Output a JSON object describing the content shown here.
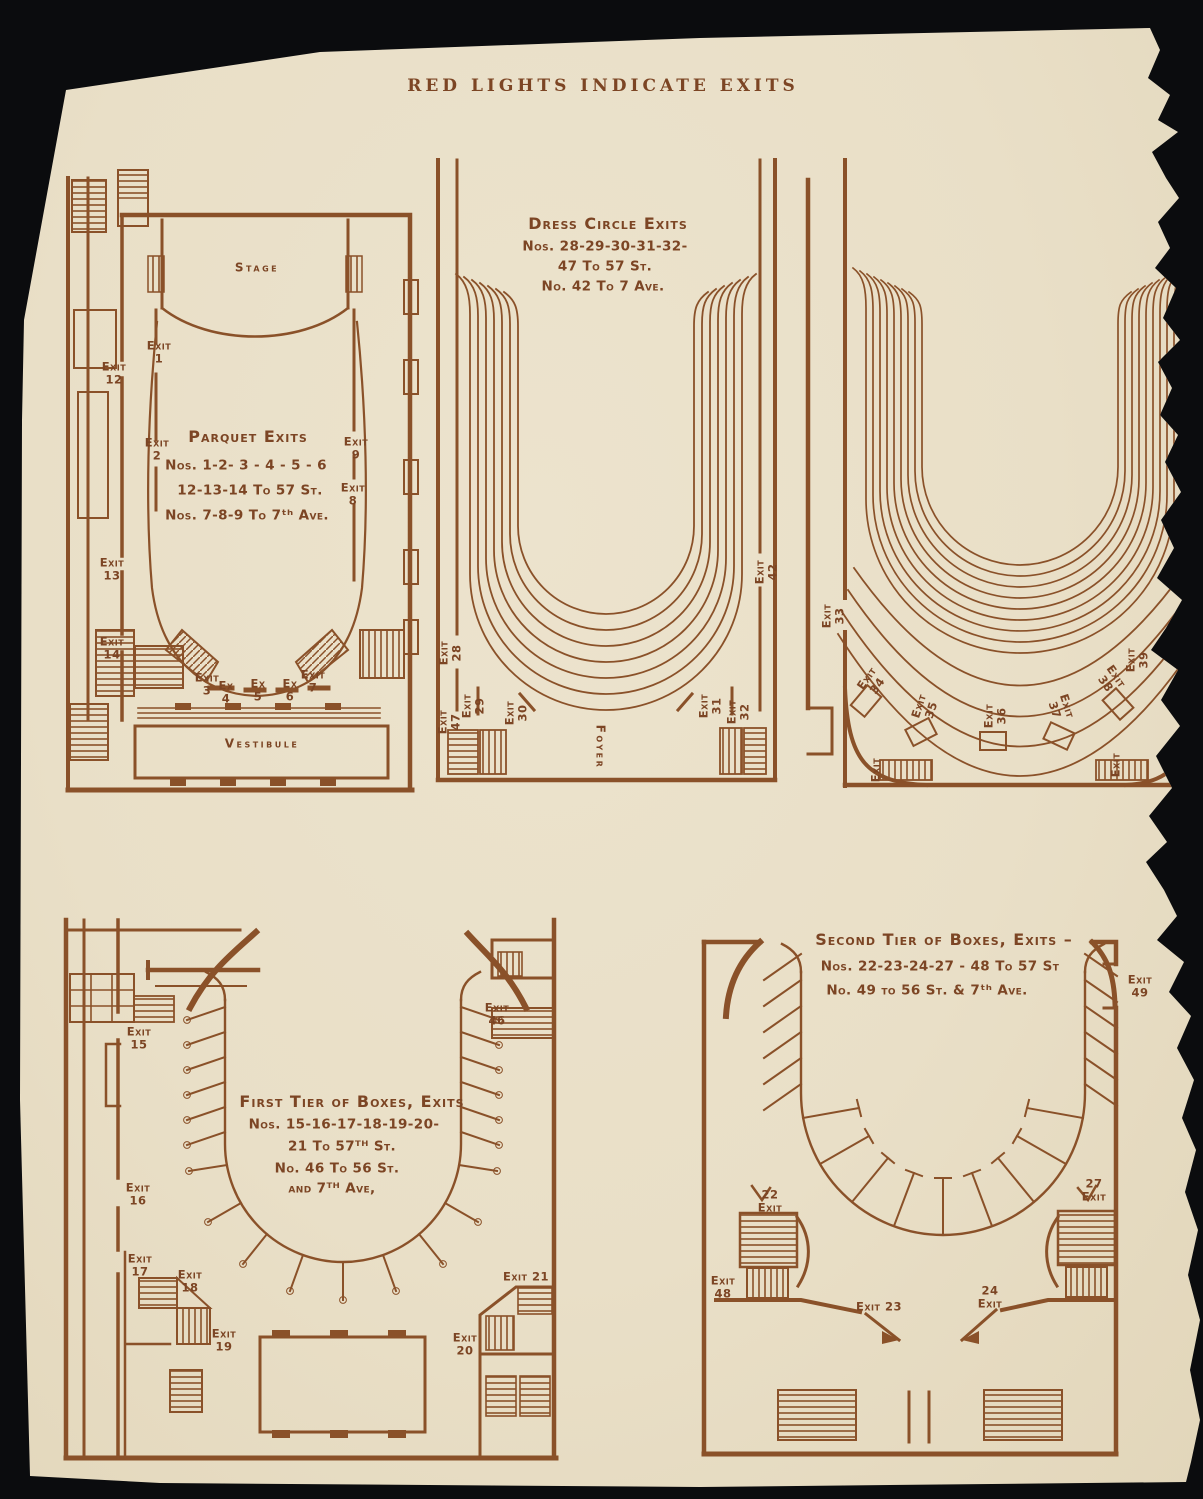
{
  "page": {
    "title": "RED LIGHTS INDICATE EXITS",
    "colors": {
      "ink": "#8a5129",
      "paper": "#e9dfc7",
      "background": "#0b0c0e"
    }
  },
  "plans": {
    "parquet": {
      "stage": "Stage",
      "vestibule": "Vestibule",
      "note": {
        "title": "Parquet Exits",
        "lines": [
          "Nos. 1-2- 3 - 4 - 5 - 6",
          "12-13-14 To 57 St.",
          "Nos. 7-8-9  To 7ᵗʰ Ave."
        ]
      },
      "exits": [
        "Exit\n1",
        "Exit\n12",
        "Exit\n2",
        "Exit\n13",
        "Exit\n14",
        "Exit\n9",
        "Exit\n8",
        "Exit\n3",
        "Ex\n4",
        "Ex\n5",
        "Ex\n6",
        "Exit\n7"
      ]
    },
    "dress_circle": {
      "foyer": "Foyer",
      "note": {
        "title": "Dress Circle Exits",
        "lines": [
          "Nos. 28-29-30-31-32-",
          "47 To 57 St.",
          "No. 42 To 7 Ave."
        ]
      },
      "exits": [
        "Exit\n28",
        "Exit\n47",
        "Exit\n29",
        "Exit\n30",
        "Exit\n31",
        "Exit\n32",
        "Exit\n42"
      ]
    },
    "balcony": {
      "exits": [
        "Exit\n33",
        "Exit\n34",
        "Exit\n35",
        "Exit\n36",
        "Exit\n37",
        "Exit\n38",
        "Exit\n39",
        "Exit",
        "Exit"
      ]
    },
    "first_tier": {
      "note": {
        "title": "First Tier of Boxes, Exits",
        "lines": [
          "Nos. 15-16-17-18-19-20-",
          "21 To 57ᵀᴴ St.",
          "No.  46 To 56 St.",
          "and 7ᵀᴴ Ave,"
        ]
      },
      "exits": [
        "Exit\n15",
        "Exit\n16",
        "Exit\n17",
        "Exit\n18",
        "Exit\n19",
        "Exit\n46",
        "Exit 21",
        "Exit\n20"
      ]
    },
    "second_tier": {
      "note": {
        "title": "Second Tier of Boxes, Exits –",
        "lines": [
          "Nos. 22-23-24-27 -  48 To 57 St",
          "No.   49 to 56 St. & 7ᵗʰ Ave."
        ]
      },
      "exits": [
        "22\nExit",
        "27\nExit",
        "Exit\n48",
        "Exit 23",
        "24\nExit",
        "Exit\n49"
      ]
    }
  }
}
